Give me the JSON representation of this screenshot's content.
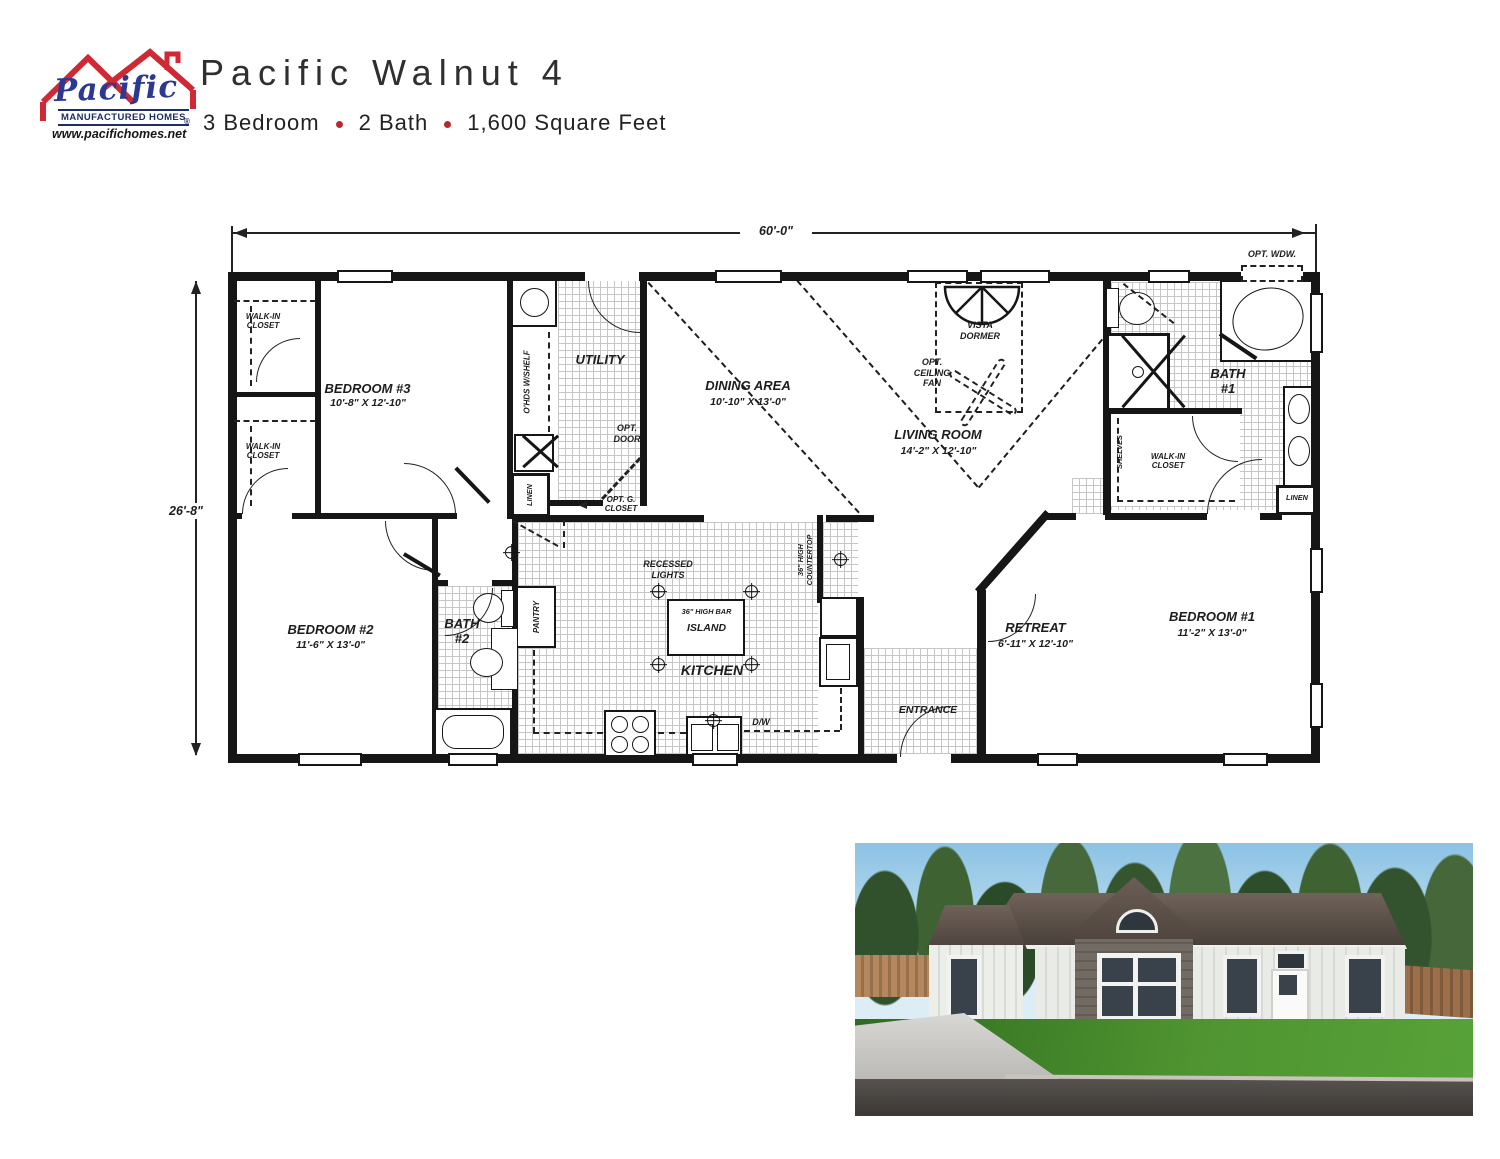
{
  "header": {
    "logo": {
      "brand": "Pacific",
      "tagline": "MANUFACTURED HOMES",
      "reg": "®",
      "website": "www.pacifichomes.net"
    },
    "title": "Pacific Walnut 4",
    "specs": {
      "bedrooms": "3 Bedroom",
      "baths": "2 Bath",
      "sqft": "1,600 Square Feet"
    }
  },
  "floorplan": {
    "dim_width": "60'-0\"",
    "dim_depth": "26'-8\"",
    "rooms": {
      "bedroom1": {
        "name": "BEDROOM #1",
        "dims": "11'-2\" X 13'-0\""
      },
      "bedroom2": {
        "name": "BEDROOM #2",
        "dims": "11'-6\" X 13'-0\""
      },
      "bedroom3": {
        "name": "BEDROOM #3",
        "dims": "10'-8\" X 12'-10\""
      },
      "living": {
        "name": "LIVING ROOM",
        "dims": "14'-2\" X 12'-10\""
      },
      "dining": {
        "name": "DINING AREA",
        "dims": "10'-10\" X 13'-0\""
      },
      "retreat": {
        "name": "RETREAT",
        "dims": "6'-11\" X 12'-10\""
      },
      "kitchen": {
        "name": "KITCHEN"
      },
      "utility": {
        "name": "UTILITY"
      },
      "bath1": {
        "name": "BATH\n#1"
      },
      "bath2": {
        "name": "BATH\n#2"
      },
      "entrance": {
        "name": "ENTRANCE"
      }
    },
    "features": {
      "walkin_closet": "WALK-IN\nCLOSET",
      "linen": "LINEN",
      "shelves": "SHELVES",
      "pantry": "PANTRY",
      "overhead_shelf": "O'HDS W/SHELF",
      "vista_dormer": "VISTA\nDORMER",
      "opt_ceiling_fan": "OPT.\nCEILING\nFAN",
      "opt_door": "OPT.\nDOOR",
      "opt_g_closet": "OPT. G.\nCLOSET",
      "opt_window": "OPT. WDW.",
      "recessed_lights": "RECESSED\nLIGHTS",
      "island_bar": "36\" HIGH BAR",
      "island": "ISLAND",
      "countertop": "36\" HIGH\nCOUNTERTOP",
      "dishwasher": "D/W"
    }
  },
  "colors": {
    "accent_red": "#b8292f",
    "logo_blue": "#2b3990",
    "wall": "#161616"
  }
}
